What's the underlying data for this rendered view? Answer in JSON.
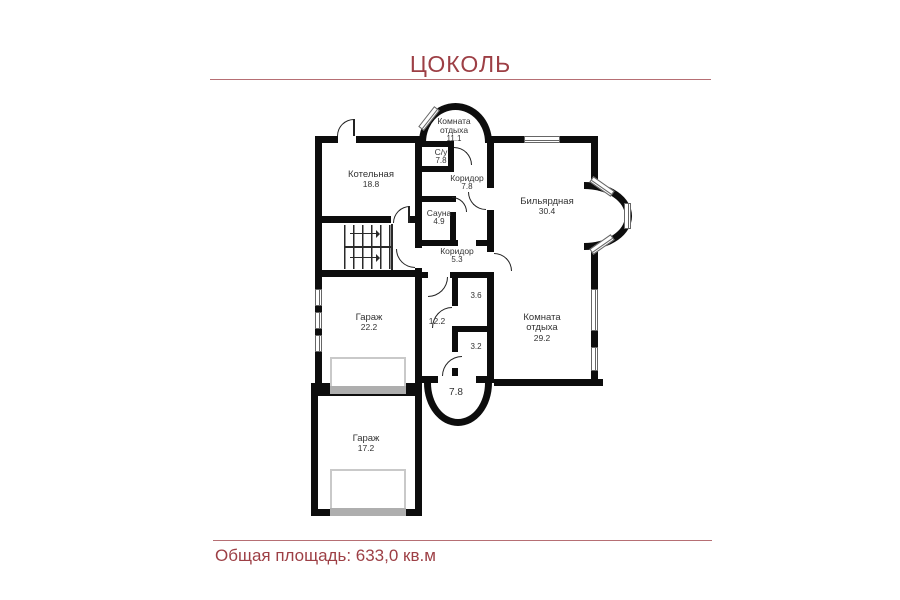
{
  "title": "ЦОКОЛЬ",
  "footer": "Общая площадь: 633,0 кв.м",
  "colors": {
    "accent": "#9d3f45",
    "wall": "#0d0d0d",
    "room_label": "#333333"
  },
  "rooms": [
    {
      "name": "Комната",
      "name2": "отдыха",
      "area": "11.1"
    },
    {
      "name": "С/у",
      "area": "7.8"
    },
    {
      "name": "Коридор",
      "area": "7.8"
    },
    {
      "name": "Котельная",
      "area": "18.8"
    },
    {
      "name": "Сауна",
      "area": "4.9"
    },
    {
      "name": "Бильярдная",
      "area": "30.4"
    },
    {
      "name": "Коридор",
      "area": "5.3"
    },
    {
      "area": "3.6"
    },
    {
      "area": "12.2"
    },
    {
      "area": "3.2"
    },
    {
      "name": "Гараж",
      "area": "22.2"
    },
    {
      "name": "Комната",
      "name2": "отдыха",
      "area": "29.2"
    },
    {
      "area": "7.8"
    },
    {
      "name": "Гараж",
      "area": "17.2"
    }
  ]
}
